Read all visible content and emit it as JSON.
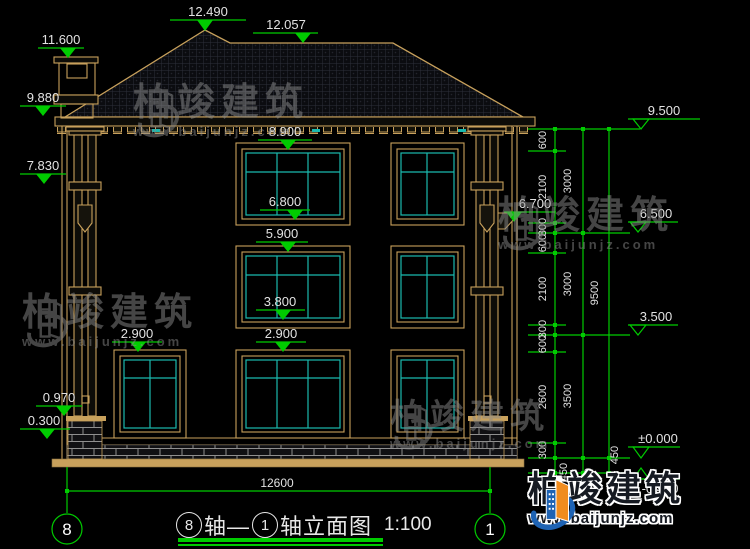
{
  "colors": {
    "line_tan": "#c8a15c",
    "glass_cyan": "#1ab9ae",
    "dim_green": "#00cc00",
    "text_white": "#e2e2e2",
    "logo_blue": "#1e63b4",
    "logo_orange": "#f08c1e",
    "watermark_gray": "#8a8a8a"
  },
  "levels": {
    "ridge": "12.490",
    "ridge_right": "12.057",
    "chimney_top": "11.600",
    "eave_left": "9.880",
    "capital_left": "7.830",
    "f3_window_head": "8.900",
    "f3_window_sill": "6.800",
    "f2_window_head": "5.900",
    "f2_window_sill": "3.800",
    "f1_window_head": "2.900",
    "f1_window_head_left": "2.900",
    "pedestal_top": "0.970",
    "base_top": "0.300",
    "eave_right": "9.500",
    "bracket_right": "6.700",
    "band_upper": "6.500",
    "band_lower": "3.500",
    "ground": "±0.000",
    "footing": "-0.450"
  },
  "dims": {
    "chain_inner": [
      "600",
      "2100",
      "300",
      "600",
      "2100",
      "300",
      "600",
      "2600",
      "300",
      "450"
    ],
    "chain_mid": [
      "3000",
      "3000",
      "3500",
      "450"
    ],
    "chain_outer": [
      "9500",
      "450"
    ],
    "total_width": "12600"
  },
  "axes": {
    "left_bubble": "8",
    "right_bubble": "1"
  },
  "title": {
    "axis_from": "8",
    "joiner": "轴—",
    "axis_to": "1",
    "suffix": "轴立面图",
    "scale": "1:100"
  },
  "watermark": {
    "brand": "柏竣建筑",
    "site": "www.baijunjz.com"
  },
  "logo": {
    "brand": "柏竣建筑",
    "site": "www.baijunjz.com"
  }
}
